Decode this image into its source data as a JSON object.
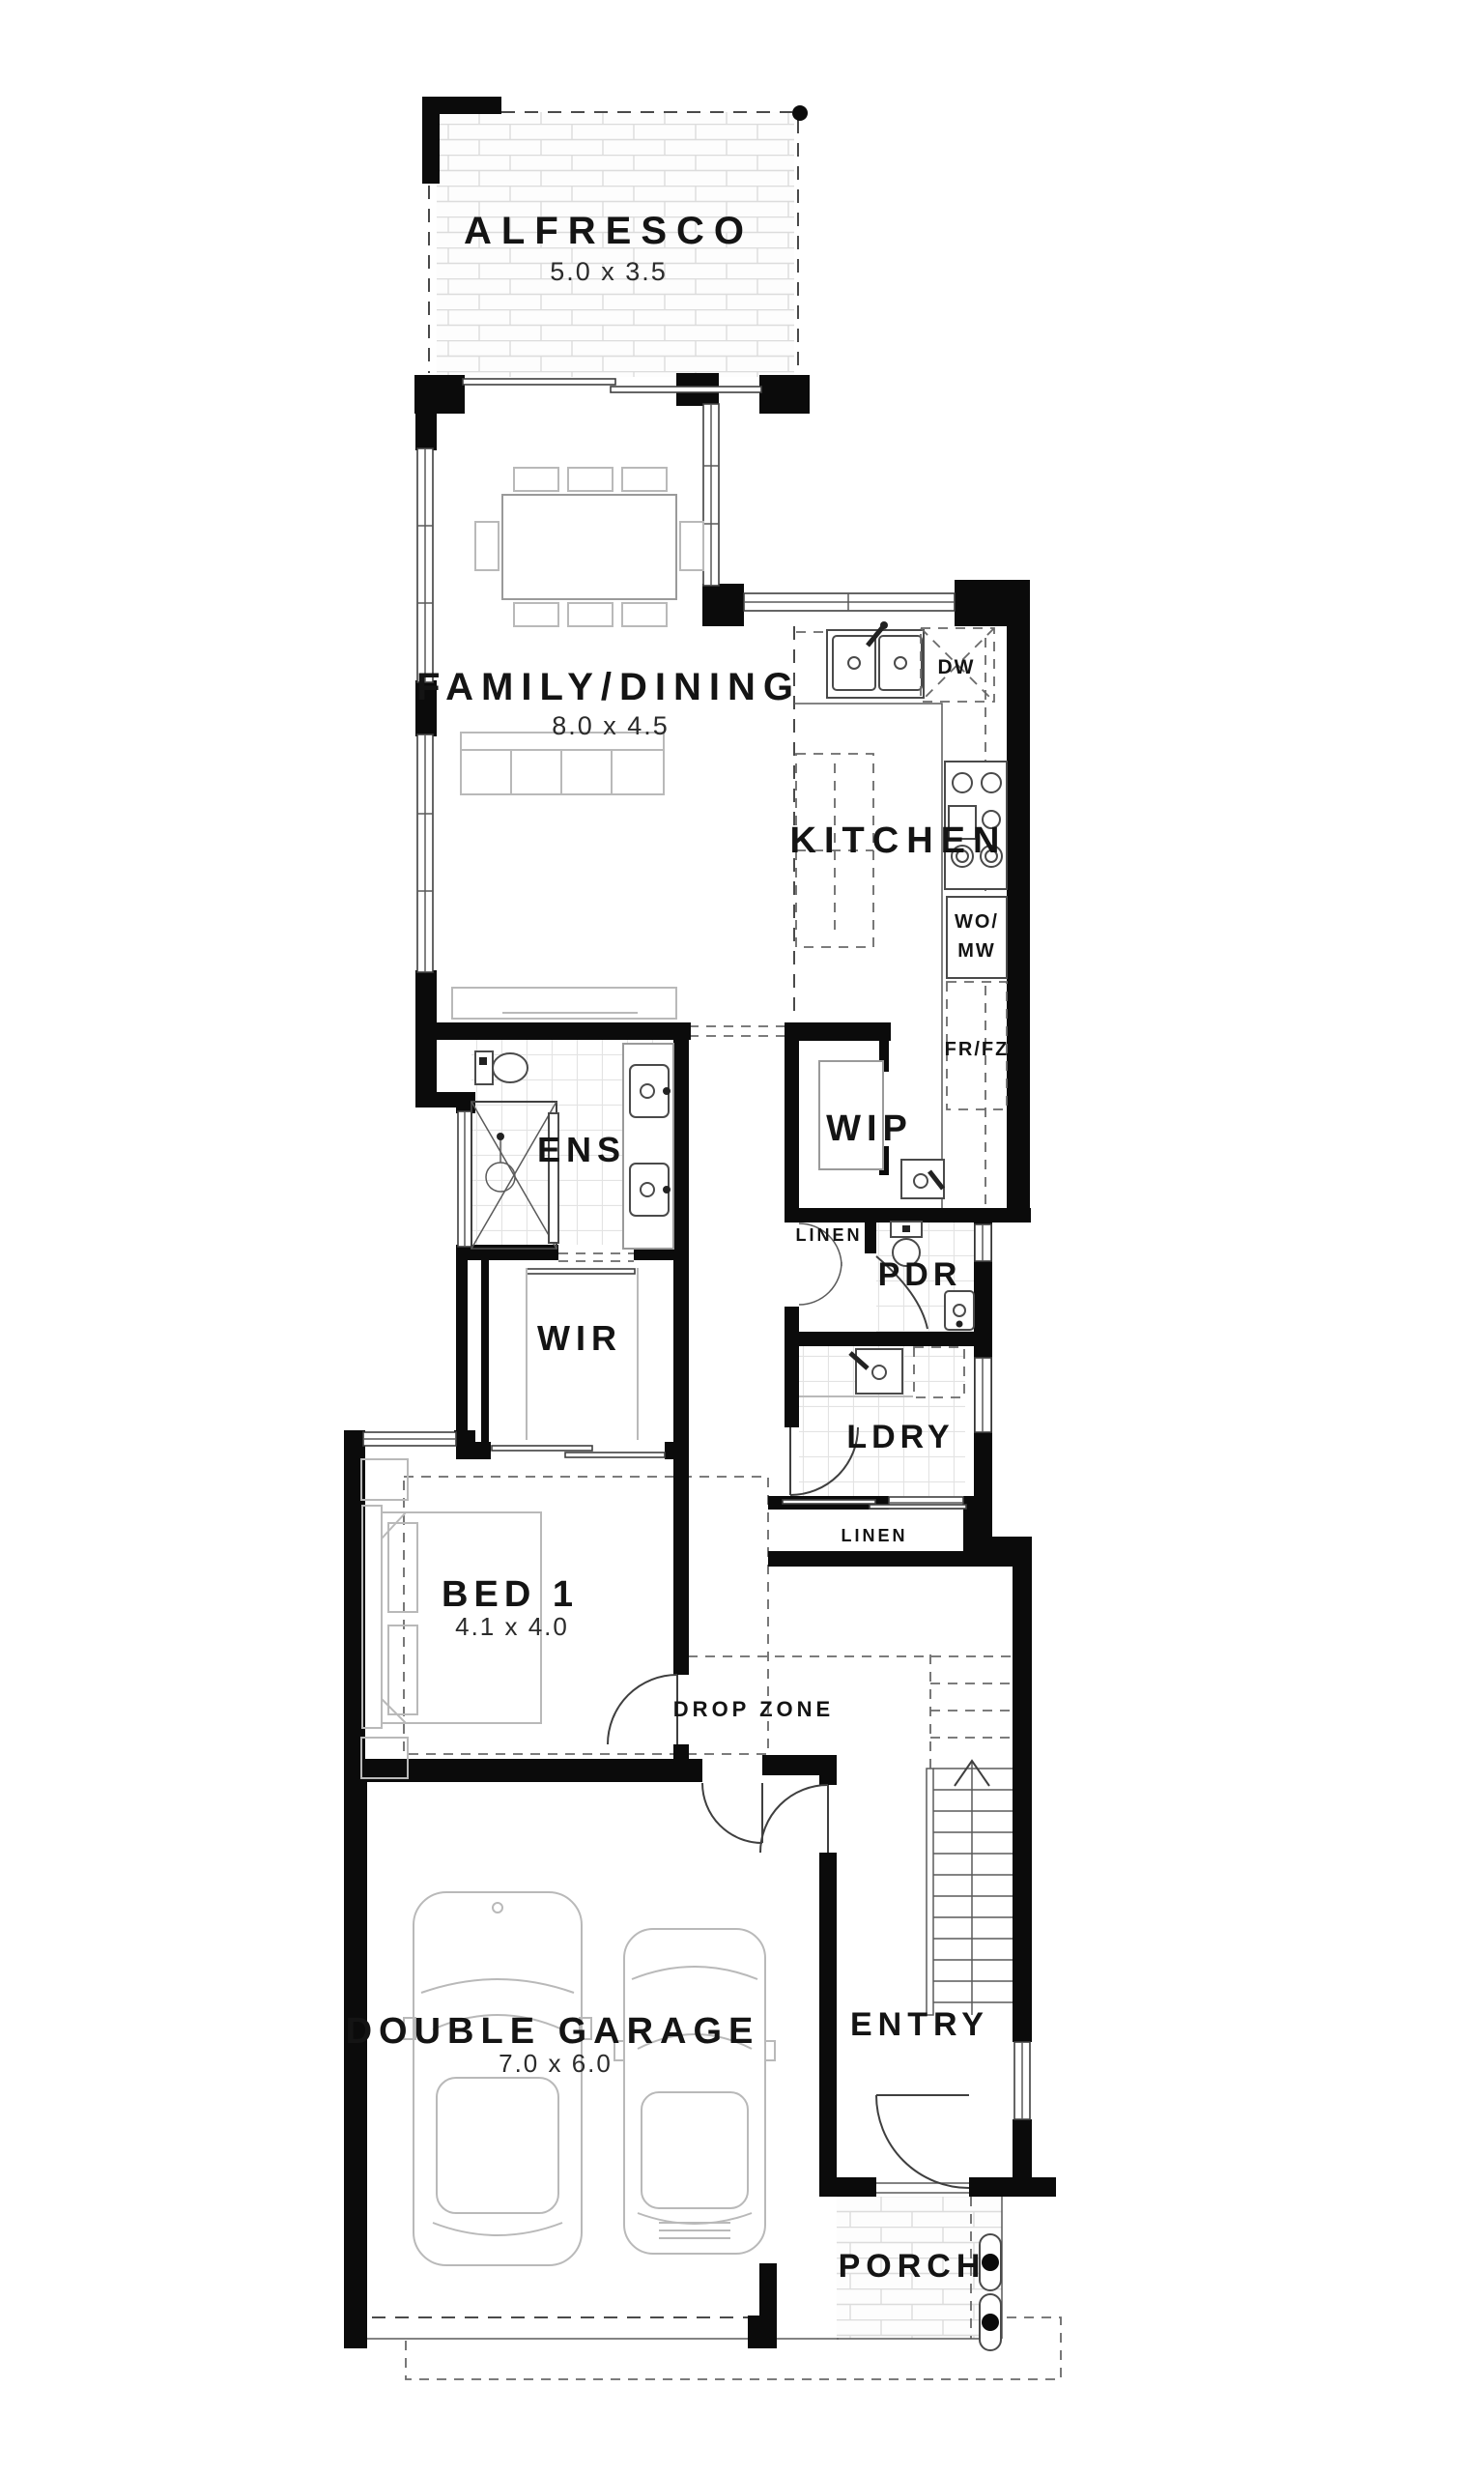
{
  "plan": {
    "type": "single-storey house floor plan (ground floor)",
    "rooms": {
      "alfresco": {
        "label": "ALFRESCO",
        "dims": "5.0 x 3.5"
      },
      "family_dining": {
        "label": "FAMILY/DINING",
        "dims": "8.0 x 4.5"
      },
      "kitchen": {
        "label": "KITCHEN"
      },
      "ens": {
        "label": "ENS"
      },
      "wip": {
        "label": "WIP"
      },
      "linen_upper": {
        "label": "LINEN"
      },
      "pdr": {
        "label": "PDR"
      },
      "wir": {
        "label": "WIR"
      },
      "ldry": {
        "label": "LDRY"
      },
      "linen_lower": {
        "label": "LINEN"
      },
      "bed1": {
        "label": "BED 1",
        "dims": "4.1 x 4.0"
      },
      "drop_zone": {
        "label": "DROP ZONE"
      },
      "double_garage": {
        "label": "DOUBLE GARAGE",
        "dims": "7.0 x 6.0"
      },
      "entry": {
        "label": "ENTRY"
      },
      "porch": {
        "label": "PORCH"
      }
    },
    "appliances": {
      "dishwasher": "DW",
      "wall_oven_microwave_line1": "WO/",
      "wall_oven_microwave_line2": "MW",
      "fridge_freezer": "FR/FZ"
    },
    "colors": {
      "wall": "#0b0b0b",
      "label_text": "#141414",
      "furniture_line": "#9a9a9a",
      "paper": "#ffffff"
    }
  }
}
